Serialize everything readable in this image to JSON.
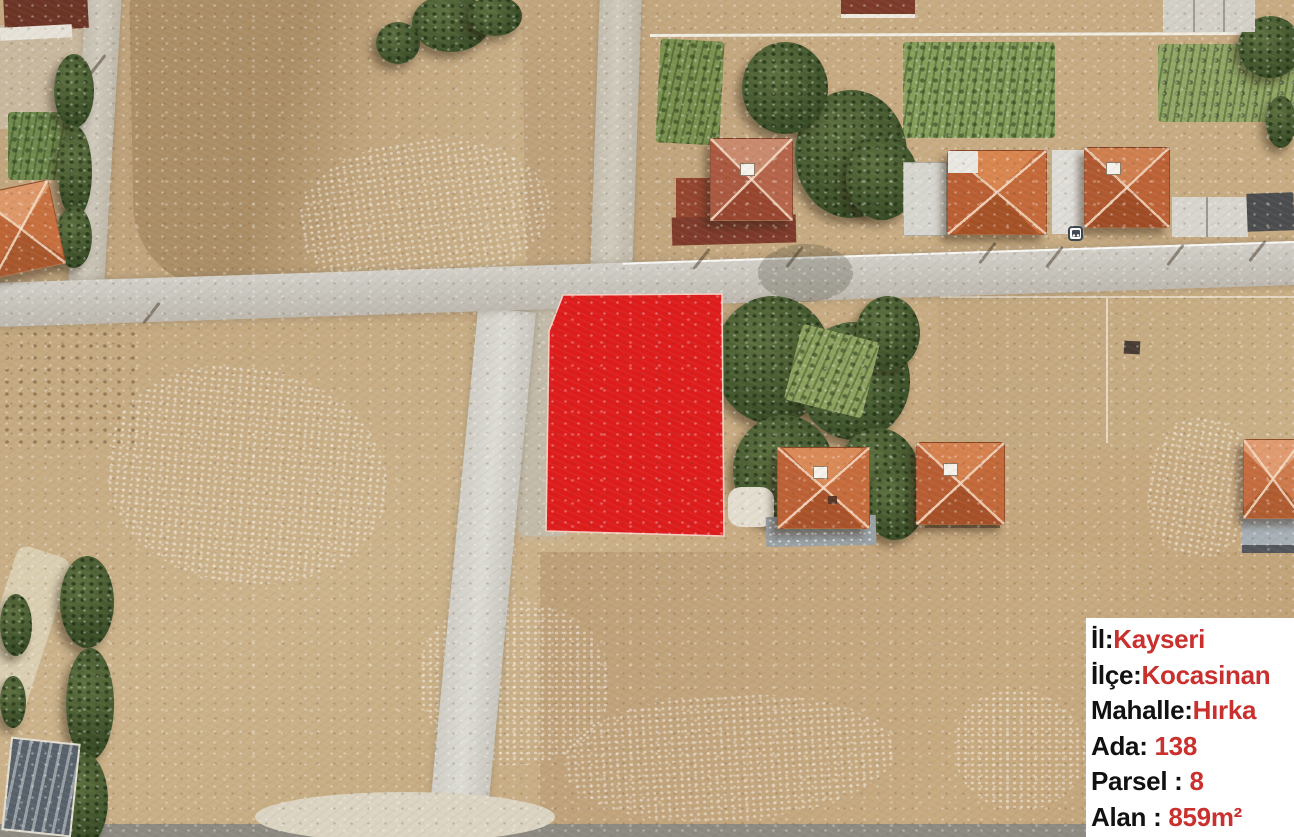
{
  "map": {
    "type": "satellite-aerial",
    "terrain_base_color": "#c7ab82",
    "road_color": "#cbc8c0",
    "tree_color": "#45552e",
    "roof_color": "#c4673a"
  },
  "icons": {
    "bus_stop": "bus-stop"
  },
  "parcel": {
    "points": "563,295 722,294 724,536 546,531 549,331",
    "fill": "#de1c1c",
    "outline": "#f6cfc4"
  },
  "info_box": {
    "background": "#ffffff",
    "label_color": "#111111",
    "value_color": "#c9302e",
    "rows": [
      {
        "label": "İl:",
        "value": "Kayseri"
      },
      {
        "label": "İlçe:",
        "value": "Kocasinan"
      },
      {
        "label": "Mahalle:",
        "value": "Hırka"
      },
      {
        "label": "Ada: ",
        "value": "138"
      },
      {
        "label": "Parsel : ",
        "value": "8"
      },
      {
        "label": "Alan : ",
        "value": "859m²"
      }
    ]
  }
}
